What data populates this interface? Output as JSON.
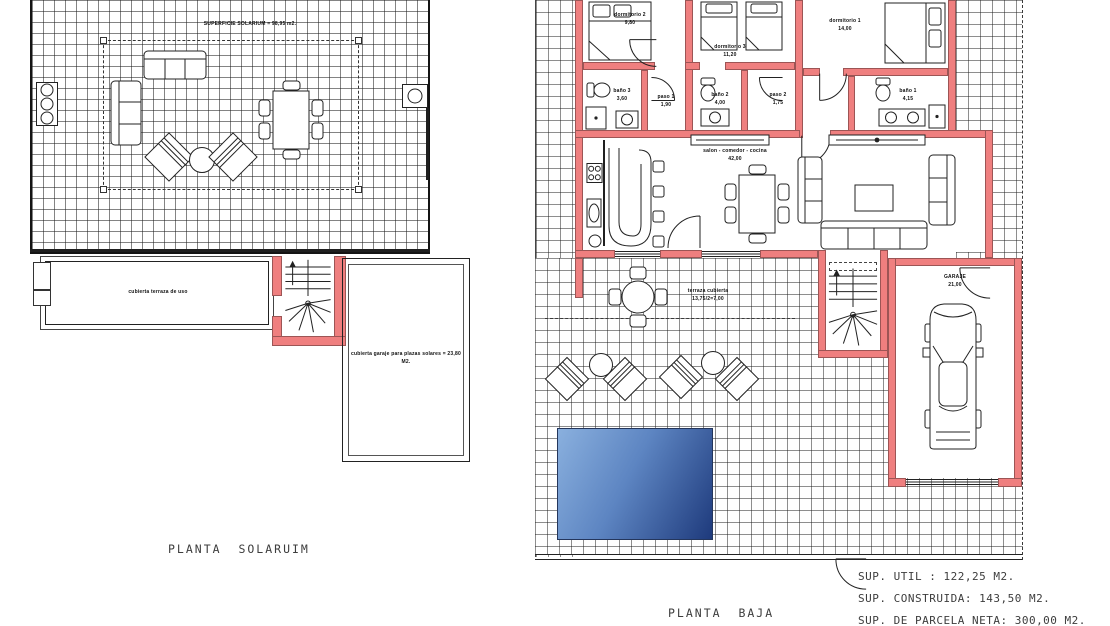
{
  "document": {
    "kind": "architectural floor plan sheet"
  },
  "colors": {
    "wall_accent": "#ef7f7f",
    "pool_light": "#8ab0de",
    "pool_dark": "#1e3a7c",
    "line": "#1f1f1f"
  },
  "plan_solarium": {
    "title": "PLANTA  SOLARUIM",
    "area_note": "SUPERFICIE SOLARIUM = 98,95 m2.",
    "labels": {
      "terrace": "cubierta terraza de uso",
      "garage_roof": "cubierta garaje para plazas solares = 23,80 M2."
    }
  },
  "plan_baja": {
    "title": "PLANTA  BAJA",
    "rooms": [
      {
        "id": "dormitorio2",
        "name": "dormitorio 2",
        "area": "9,80"
      },
      {
        "id": "dormitorio3",
        "name": "dormitorio 3",
        "area": "11,20"
      },
      {
        "id": "dormitorio1",
        "name": "dormitorio 1",
        "area": "14,00"
      },
      {
        "id": "bano3",
        "name": "baño 3",
        "area": "3,60"
      },
      {
        "id": "paso1",
        "name": "paso 1",
        "area": "1,90"
      },
      {
        "id": "bano2",
        "name": "baño 2",
        "area": "4,00"
      },
      {
        "id": "paso2",
        "name": "paso 2",
        "area": "1,75"
      },
      {
        "id": "bano1",
        "name": "baño 1",
        "area": "4,15"
      },
      {
        "id": "salon",
        "name": "salon - comedor - cocina",
        "area": "42,00"
      },
      {
        "id": "terraza",
        "name": "terraza cubierta",
        "area": "13,75/2=7,00"
      },
      {
        "id": "garaje",
        "name": "GARAJE",
        "area": "21,00"
      }
    ]
  },
  "summary": {
    "lines": [
      "SUP.  UTIL  :  122,25  M2.",
      "SUP.  CONSTRUIDA:  143,50  M2.",
      "SUP.  DE  PARCELA  NETA:  300,00  M2."
    ]
  },
  "icons": {
    "stairs": "winder-staircase",
    "car": "car-top-view",
    "pool": "swimming-pool"
  }
}
